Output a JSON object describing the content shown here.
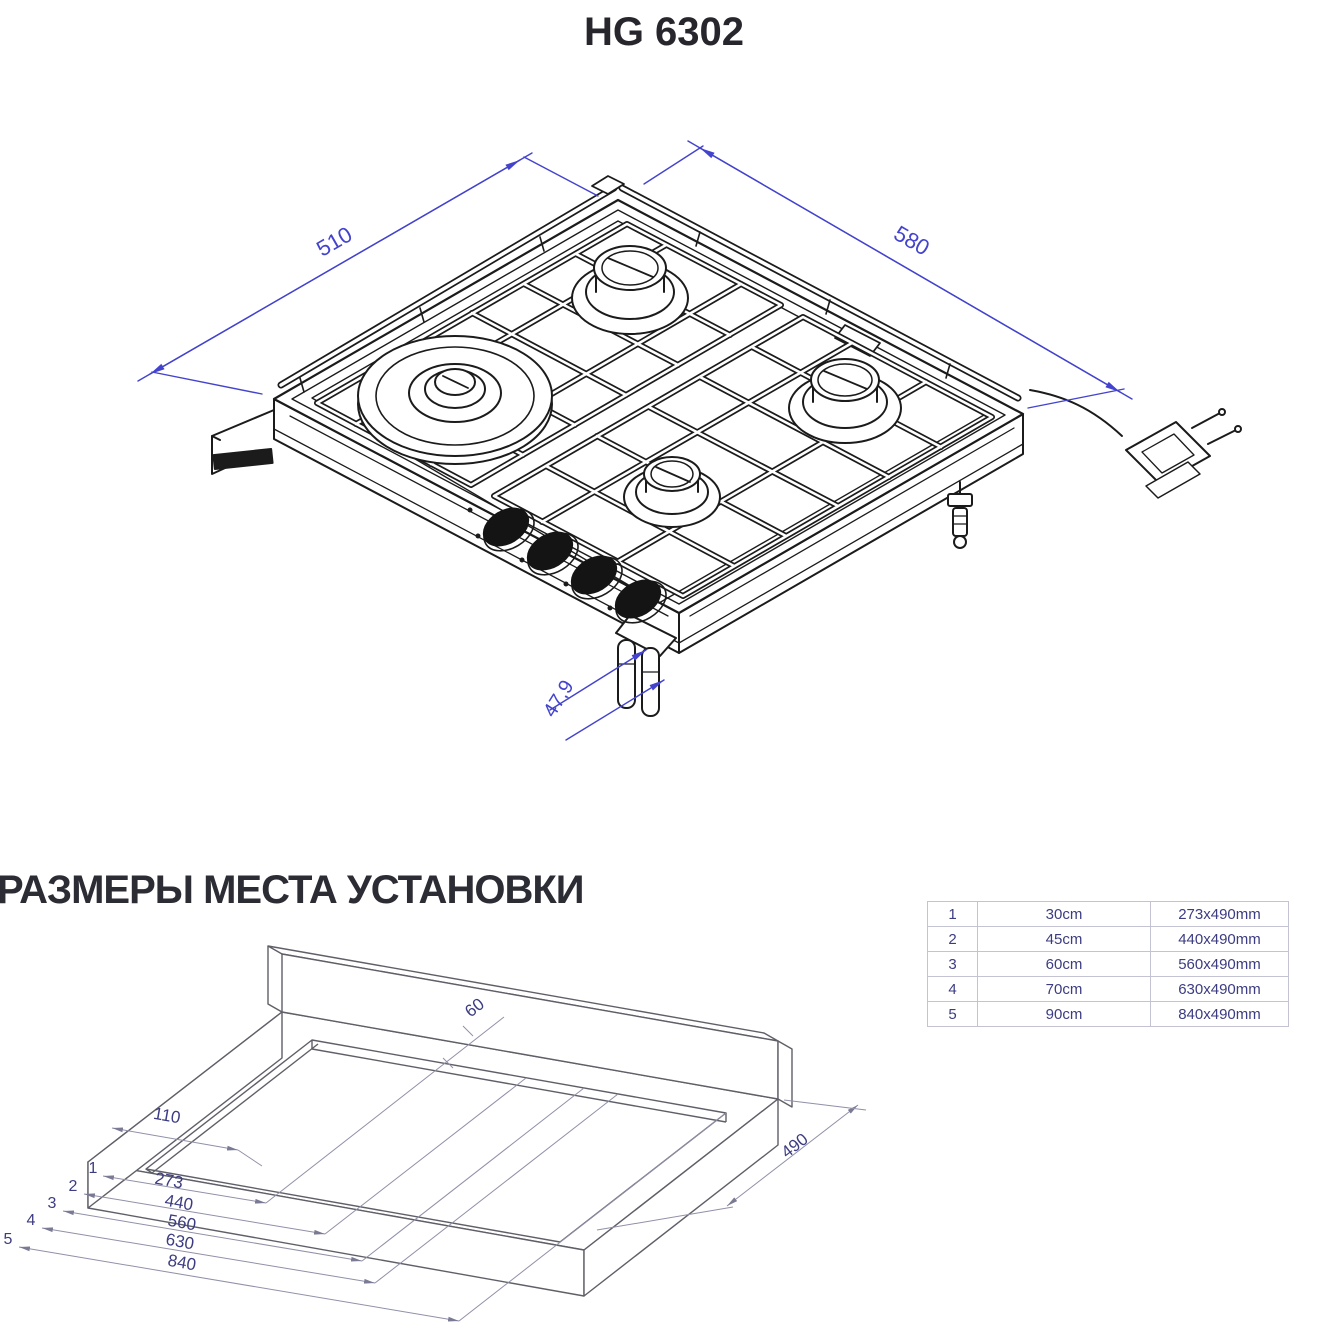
{
  "page_title": "HG 6302",
  "section_title": "РАЗМЕРЫ МЕСТА УСТАНОВКИ",
  "colors": {
    "hob_line": "#1b1b1b",
    "dim_blue": "#4343ce",
    "counter_line": "#5f5f68",
    "dim_gray": "#9090a8",
    "label_navy": "#3c3c82",
    "table_border": "#c3c3d3"
  },
  "hob_drawing": {
    "dim_depth": "510",
    "dim_width": "580",
    "dim_height": "47,9"
  },
  "install_drawing": {
    "back_gap": "60",
    "left_gap": "110",
    "depth": "490",
    "cut_widths": [
      {
        "marker": "1",
        "value": "273"
      },
      {
        "marker": "2",
        "value": "440"
      },
      {
        "marker": "3",
        "value": "560"
      },
      {
        "marker": "4",
        "value": "630"
      },
      {
        "marker": "5",
        "value": "840"
      }
    ]
  },
  "size_table": {
    "rows": [
      {
        "num": "1",
        "size": "30cm",
        "cutout": "273x490mm"
      },
      {
        "num": "2",
        "size": "45cm",
        "cutout": "440x490mm"
      },
      {
        "num": "3",
        "size": "60cm",
        "cutout": "560x490mm"
      },
      {
        "num": "4",
        "size": "70cm",
        "cutout": "630x490mm"
      },
      {
        "num": "5",
        "size": "90cm",
        "cutout": "840x490mm"
      }
    ]
  }
}
